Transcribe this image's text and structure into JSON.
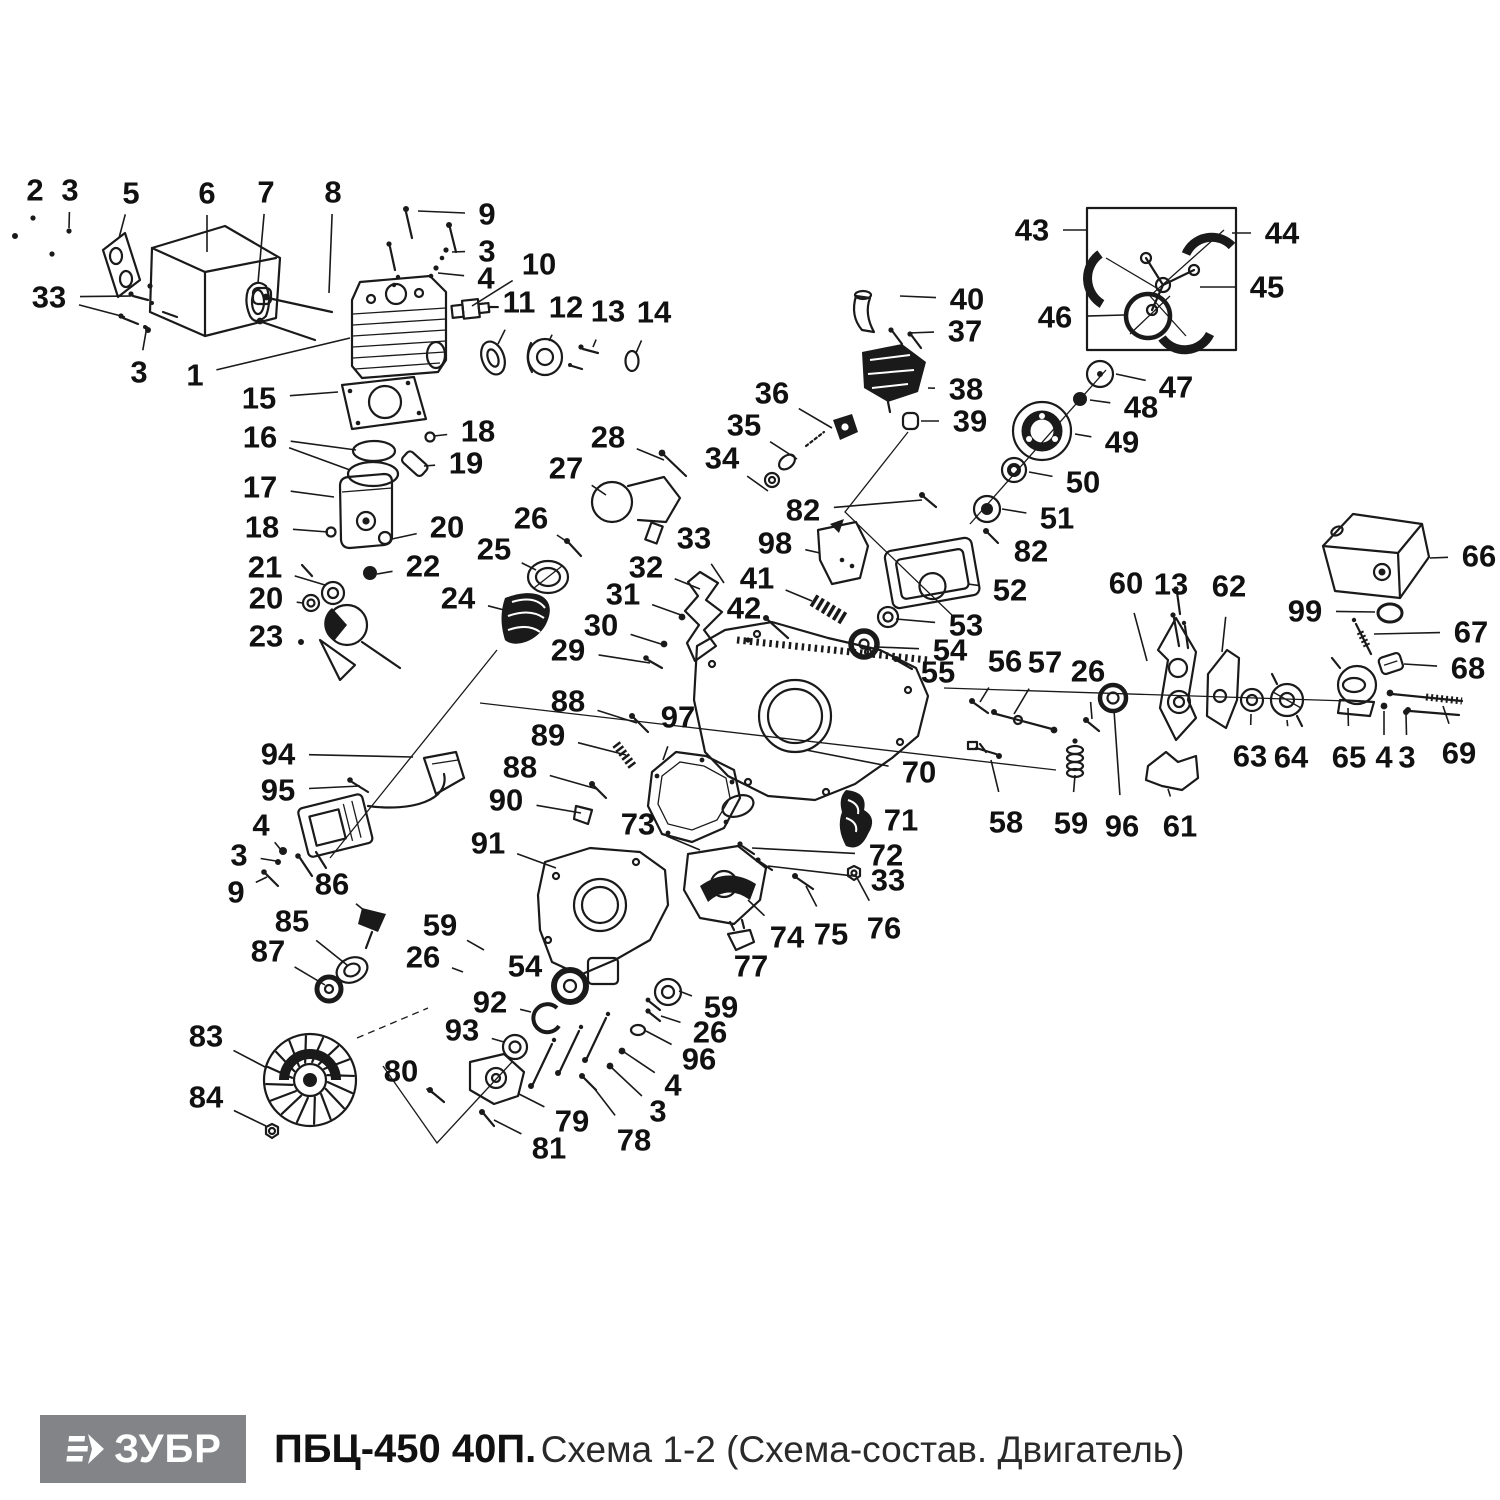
{
  "footer": {
    "logo_text": "ЗУБР",
    "title_bold": "ПБЦ-450 40П.",
    "title_regular": "Схема 1-2 (Схема-состав. Двигатель)"
  },
  "diagram": {
    "type": "exploded-parts-diagram",
    "subject": "chainsaw engine",
    "stroke_color": "#1a1a1a",
    "label_font_size": 31,
    "part_labels": [
      {
        "n": "2",
        "x": 35,
        "y": 190,
        "lx": 33,
        "ly": 214
      },
      {
        "n": "3",
        "x": 70,
        "y": 190,
        "lx": 69,
        "ly": 228
      },
      {
        "n": "5",
        "x": 131,
        "y": 193,
        "lx": 119,
        "ly": 238
      },
      {
        "n": "6",
        "x": 207,
        "y": 193,
        "lx": 207,
        "ly": 252
      },
      {
        "n": "7",
        "x": 266,
        "y": 192,
        "lx": 258,
        "ly": 283
      },
      {
        "n": "8",
        "x": 333,
        "y": 192,
        "lx": 329,
        "ly": 293
      },
      {
        "n": "9",
        "x": 487,
        "y": 214,
        "lx": 418,
        "ly": 211
      },
      {
        "n": "3",
        "x": 487,
        "y": 251,
        "lx": 452,
        "ly": 252
      },
      {
        "n": "4",
        "x": 486,
        "y": 278,
        "lx": 438,
        "ly": 273
      },
      {
        "n": "10",
        "x": 539,
        "y": 264,
        "lx": 472,
        "ly": 306
      },
      {
        "n": "11",
        "x": 519,
        "y": 302,
        "lx": 498,
        "ly": 344
      },
      {
        "n": "12",
        "x": 566,
        "y": 307,
        "lx": 549,
        "ly": 341
      },
      {
        "n": "13",
        "x": 608,
        "y": 311,
        "lx": 593,
        "ly": 347
      },
      {
        "n": "14",
        "x": 654,
        "y": 312,
        "lx": 636,
        "ly": 353
      },
      {
        "n": "33",
        "x": 49,
        "y": 297,
        "lx": 131,
        "ly": 296,
        "lx2": 125,
        "ly2": 317
      },
      {
        "n": "3",
        "x": 139,
        "y": 372,
        "lx": 147,
        "ly": 326
      },
      {
        "n": "1",
        "x": 195,
        "y": 375,
        "lx": 350,
        "ly": 338
      },
      {
        "n": "15",
        "x": 259,
        "y": 398,
        "lx": 338,
        "ly": 392
      },
      {
        "n": "16",
        "x": 260,
        "y": 437,
        "lx": 356,
        "ly": 450,
        "lx2": 350,
        "ly2": 470
      },
      {
        "n": "17",
        "x": 260,
        "y": 487,
        "lx": 334,
        "ly": 497
      },
      {
        "n": "18",
        "x": 262,
        "y": 527,
        "lx": 328,
        "ly": 532
      },
      {
        "n": "21",
        "x": 265,
        "y": 567,
        "lx": 325,
        "ly": 585
      },
      {
        "n": "20",
        "x": 266,
        "y": 598,
        "lx": 303,
        "ly": 603
      },
      {
        "n": "23",
        "x": 266,
        "y": 636,
        "lx": 299,
        "ly": 641
      },
      {
        "n": "18",
        "x": 478,
        "y": 431,
        "lx": 434,
        "ly": 436
      },
      {
        "n": "19",
        "x": 466,
        "y": 463,
        "lx": 424,
        "ly": 466
      },
      {
        "n": "20",
        "x": 447,
        "y": 527,
        "lx": 392,
        "ly": 539
      },
      {
        "n": "22",
        "x": 423,
        "y": 566,
        "lx": 377,
        "ly": 574
      },
      {
        "n": "24",
        "x": 458,
        "y": 598,
        "lx": 508,
        "ly": 611
      },
      {
        "n": "25",
        "x": 494,
        "y": 549,
        "lx": 536,
        "ly": 570
      },
      {
        "n": "26",
        "x": 531,
        "y": 518,
        "lx": 569,
        "ly": 543
      },
      {
        "n": "27",
        "x": 566,
        "y": 468,
        "lx": 606,
        "ly": 495
      },
      {
        "n": "28",
        "x": 608,
        "y": 437,
        "lx": 664,
        "ly": 460
      },
      {
        "n": "29",
        "x": 568,
        "y": 650,
        "lx": 650,
        "ly": 663
      },
      {
        "n": "30",
        "x": 601,
        "y": 625,
        "lx": 661,
        "ly": 644
      },
      {
        "n": "31",
        "x": 623,
        "y": 594,
        "lx": 681,
        "ly": 615
      },
      {
        "n": "32",
        "x": 646,
        "y": 567,
        "lx": 700,
        "ly": 589
      },
      {
        "n": "33",
        "x": 694,
        "y": 538,
        "lx": 724,
        "ly": 583
      },
      {
        "n": "34",
        "x": 722,
        "y": 458,
        "lx": 768,
        "ly": 491
      },
      {
        "n": "35",
        "x": 744,
        "y": 425,
        "lx": 797,
        "ly": 459
      },
      {
        "n": "36",
        "x": 772,
        "y": 393,
        "lx": 832,
        "ly": 428
      },
      {
        "n": "41",
        "x": 757,
        "y": 578,
        "lx": 812,
        "ly": 601
      },
      {
        "n": "42",
        "x": 744,
        "y": 608,
        "lx": 770,
        "ly": 622
      },
      {
        "n": "82",
        "x": 803,
        "y": 510,
        "lx": 922,
        "ly": 500
      },
      {
        "n": "98",
        "x": 775,
        "y": 543,
        "lx": 820,
        "ly": 553
      },
      {
        "n": "52",
        "x": 1010,
        "y": 590,
        "lx": 968,
        "ly": 584
      },
      {
        "n": "53",
        "x": 966,
        "y": 625,
        "lx": 896,
        "ly": 619
      },
      {
        "n": "54",
        "x": 950,
        "y": 650,
        "lx": 877,
        "ly": 647
      },
      {
        "n": "55",
        "x": 938,
        "y": 672,
        "lx": 903,
        "ly": 664
      },
      {
        "n": "56",
        "x": 1005,
        "y": 661,
        "lx": 980,
        "ly": 702
      },
      {
        "n": "57",
        "x": 1045,
        "y": 662,
        "lx": 1014,
        "ly": 714
      },
      {
        "n": "26",
        "x": 1088,
        "y": 671,
        "lx": 1092,
        "ly": 719
      },
      {
        "n": "60",
        "x": 1126,
        "y": 583,
        "lx": 1147,
        "ly": 661
      },
      {
        "n": "13",
        "x": 1171,
        "y": 584,
        "lx": 1177,
        "ly": 616
      },
      {
        "n": "62",
        "x": 1229,
        "y": 586,
        "lx": 1222,
        "ly": 652
      },
      {
        "n": "99",
        "x": 1305,
        "y": 611,
        "lx": 1375,
        "ly": 612
      },
      {
        "n": "66",
        "x": 1479,
        "y": 556,
        "lx": 1430,
        "ly": 558
      },
      {
        "n": "67",
        "x": 1471,
        "y": 632,
        "lx": 1374,
        "ly": 634
      },
      {
        "n": "68",
        "x": 1468,
        "y": 668,
        "lx": 1404,
        "ly": 664
      },
      {
        "n": "63",
        "x": 1250,
        "y": 756,
        "lx": 1251,
        "ly": 714
      },
      {
        "n": "64",
        "x": 1291,
        "y": 757,
        "lx": 1287,
        "ly": 720
      },
      {
        "n": "65",
        "x": 1349,
        "y": 757,
        "lx": 1348,
        "ly": 708
      },
      {
        "n": "4",
        "x": 1384,
        "y": 757,
        "lx": 1384,
        "ly": 711
      },
      {
        "n": "3",
        "x": 1407,
        "y": 757,
        "lx": 1406,
        "ly": 714
      },
      {
        "n": "69",
        "x": 1459,
        "y": 753,
        "lx": 1443,
        "ly": 706
      },
      {
        "n": "43",
        "x": 1032,
        "y": 230,
        "lx": 1086,
        "ly": 230
      },
      {
        "n": "44",
        "x": 1282,
        "y": 233,
        "lx": 1232,
        "ly": 233
      },
      {
        "n": "45",
        "x": 1267,
        "y": 287,
        "lx": 1200,
        "ly": 287
      },
      {
        "n": "46",
        "x": 1055,
        "y": 317,
        "lx": 1124,
        "ly": 315
      },
      {
        "n": "47",
        "x": 1176,
        "y": 387,
        "lx": 1116,
        "ly": 374
      },
      {
        "n": "48",
        "x": 1141,
        "y": 407,
        "lx": 1090,
        "ly": 400
      },
      {
        "n": "49",
        "x": 1122,
        "y": 442,
        "lx": 1075,
        "ly": 434
      },
      {
        "n": "50",
        "x": 1083,
        "y": 482,
        "lx": 1029,
        "ly": 472
      },
      {
        "n": "51",
        "x": 1057,
        "y": 518,
        "lx": 1002,
        "ly": 509
      },
      {
        "n": "82",
        "x": 1031,
        "y": 551,
        "lx": 999,
        "ly": 540
      },
      {
        "n": "40",
        "x": 967,
        "y": 299,
        "lx": 900,
        "ly": 296
      },
      {
        "n": "37",
        "x": 965,
        "y": 331,
        "lx": 908,
        "ly": 333
      },
      {
        "n": "38",
        "x": 966,
        "y": 389,
        "lx": 928,
        "ly": 388
      },
      {
        "n": "39",
        "x": 970,
        "y": 421,
        "lx": 921,
        "ly": 421
      },
      {
        "n": "88",
        "x": 568,
        "y": 701,
        "lx": 637,
        "ly": 723
      },
      {
        "n": "89",
        "x": 548,
        "y": 735,
        "lx": 626,
        "ly": 755
      },
      {
        "n": "97",
        "x": 678,
        "y": 717,
        "lx": 663,
        "ly": 760
      },
      {
        "n": "88",
        "x": 520,
        "y": 767,
        "lx": 597,
        "ly": 789
      },
      {
        "n": "90",
        "x": 506,
        "y": 800,
        "lx": 581,
        "ly": 813
      },
      {
        "n": "91",
        "x": 488,
        "y": 843,
        "lx": 556,
        "ly": 868
      },
      {
        "n": "73",
        "x": 638,
        "y": 824,
        "lx": 700,
        "ly": 850
      },
      {
        "n": "70",
        "x": 919,
        "y": 772,
        "lx": 806,
        "ly": 750
      },
      {
        "n": "71",
        "x": 901,
        "y": 820,
        "lx": 876,
        "ly": 816
      },
      {
        "n": "72",
        "x": 886,
        "y": 855,
        "lx": 752,
        "ly": 848
      },
      {
        "n": "33",
        "x": 888,
        "y": 880,
        "lx": 768,
        "ly": 866
      },
      {
        "n": "74",
        "x": 787,
        "y": 937,
        "lx": 748,
        "ly": 900
      },
      {
        "n": "75",
        "x": 831,
        "y": 934,
        "lx": 806,
        "ly": 886
      },
      {
        "n": "76",
        "x": 884,
        "y": 928,
        "lx": 856,
        "ly": 876
      },
      {
        "n": "77",
        "x": 751,
        "y": 966,
        "lx": 739,
        "ly": 946
      },
      {
        "n": "58",
        "x": 1006,
        "y": 822,
        "lx": 991,
        "ly": 760
      },
      {
        "n": "59",
        "x": 1071,
        "y": 823,
        "lx": 1075,
        "ly": 775
      },
      {
        "n": "96",
        "x": 1122,
        "y": 826,
        "lx": 1114,
        "ly": 710
      },
      {
        "n": "61",
        "x": 1180,
        "y": 826,
        "lx": 1168,
        "ly": 789
      },
      {
        "n": "94",
        "x": 278,
        "y": 754,
        "lx": 413,
        "ly": 757
      },
      {
        "n": "95",
        "x": 278,
        "y": 790,
        "lx": 360,
        "ly": 786
      },
      {
        "n": "4",
        "x": 261,
        "y": 825,
        "lx": 281,
        "ly": 850
      },
      {
        "n": "3",
        "x": 239,
        "y": 855,
        "lx": 276,
        "ly": 861
      },
      {
        "n": "9",
        "x": 236,
        "y": 892,
        "lx": 267,
        "ly": 877
      },
      {
        "n": "86",
        "x": 332,
        "y": 884,
        "lx": 371,
        "ly": 916
      },
      {
        "n": "85",
        "x": 292,
        "y": 921,
        "lx": 347,
        "ly": 965
      },
      {
        "n": "87",
        "x": 268,
        "y": 951,
        "lx": 325,
        "ly": 985
      },
      {
        "n": "83",
        "x": 206,
        "y": 1036,
        "lx": 267,
        "ly": 1068
      },
      {
        "n": "84",
        "x": 206,
        "y": 1097,
        "lx": 266,
        "ly": 1126
      },
      {
        "n": "80",
        "x": 401,
        "y": 1071,
        "lx": 434,
        "ly": 1094
      },
      {
        "n": "59",
        "x": 440,
        "y": 925,
        "lx": 484,
        "ly": 950
      },
      {
        "n": "26",
        "x": 423,
        "y": 957,
        "lx": 463,
        "ly": 972
      },
      {
        "n": "54",
        "x": 525,
        "y": 966,
        "lx": 558,
        "ly": 978
      },
      {
        "n": "92",
        "x": 490,
        "y": 1002,
        "lx": 531,
        "ly": 1012
      },
      {
        "n": "93",
        "x": 462,
        "y": 1030,
        "lx": 504,
        "ly": 1042
      },
      {
        "n": "79",
        "x": 572,
        "y": 1121,
        "lx": 519,
        "ly": 1094
      },
      {
        "n": "81",
        "x": 549,
        "y": 1148,
        "lx": 494,
        "ly": 1120
      },
      {
        "n": "78",
        "x": 634,
        "y": 1140,
        "lx": 594,
        "ly": 1088
      },
      {
        "n": "3",
        "x": 658,
        "y": 1111,
        "lx": 612,
        "ly": 1068
      },
      {
        "n": "4",
        "x": 673,
        "y": 1085,
        "lx": 624,
        "ly": 1052
      },
      {
        "n": "96",
        "x": 699,
        "y": 1059,
        "lx": 646,
        "ly": 1031
      },
      {
        "n": "26",
        "x": 710,
        "y": 1032,
        "lx": 661,
        "ly": 1016
      },
      {
        "n": "59",
        "x": 721,
        "y": 1007,
        "lx": 679,
        "ly": 991
      }
    ]
  }
}
